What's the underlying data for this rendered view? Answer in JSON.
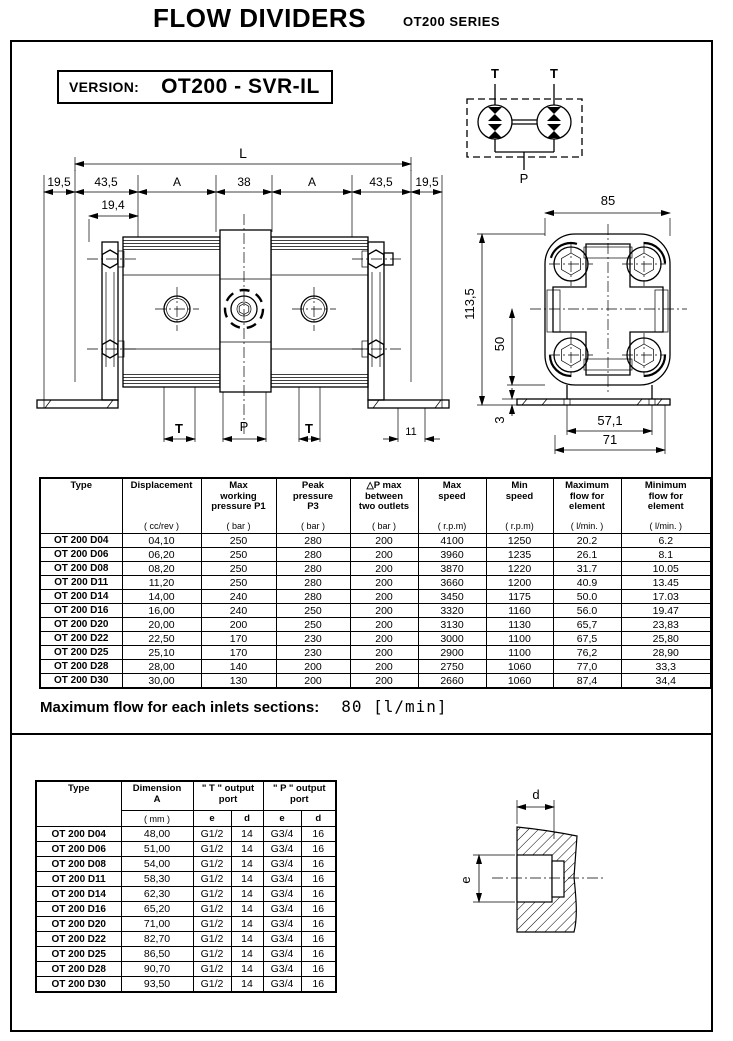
{
  "page": {
    "title": "FLOW DIVIDERS",
    "series": "OT200  SERIES",
    "version_label": "VERSION:",
    "version_value": "OT200 - SVR-IL"
  },
  "schematic": {
    "outlet_left": "T",
    "outlet_right": "T",
    "inlet": "P"
  },
  "front_view": {
    "dim_overall": "L",
    "dims_top": [
      "19,5",
      "43,5",
      "A",
      "38",
      "A",
      "43,5",
      "19,5"
    ],
    "dim_sub": "19,4",
    "port_left": "T",
    "port_center": "P",
    "port_right": "T",
    "dim_right": "11"
  },
  "end_view": {
    "dim_width": "85",
    "dim_height": "113,5",
    "dim_center": "50",
    "dim_base": "3",
    "dim_holes": "57,1",
    "dim_base_width": "71"
  },
  "spec_table": {
    "headers": [
      {
        "name": "Type",
        "unit": ""
      },
      {
        "name": "Displacement",
        "unit": "( cc/rev )"
      },
      {
        "name": "Max\nworking\npressure P1",
        "unit": "( bar )"
      },
      {
        "name": "Peak\npressure\nP3",
        "unit": "( bar )"
      },
      {
        "name": "△P  max\nbetween\ntwo outlets",
        "unit": "( bar )"
      },
      {
        "name": "Max\nspeed",
        "unit": "( r.p.m)"
      },
      {
        "name": "Min\nspeed",
        "unit": "( r.p.m)"
      },
      {
        "name": "Maximum\nflow for\nelement",
        "unit": "( l/min. )"
      },
      {
        "name": "Minimum\nflow for\nelement",
        "unit": "( l/min. )"
      }
    ],
    "rows": [
      [
        "OT 200 D04",
        "04,10",
        "250",
        "280",
        "200",
        "4100",
        "1250",
        "20.2",
        "6.2"
      ],
      [
        "OT 200 D06",
        "06,20",
        "250",
        "280",
        "200",
        "3960",
        "1235",
        "26.1",
        "8.1"
      ],
      [
        "OT 200 D08",
        "08,20",
        "250",
        "280",
        "200",
        "3870",
        "1220",
        "31.7",
        "10.05"
      ],
      [
        "OT 200 D11",
        "11,20",
        "250",
        "280",
        "200",
        "3660",
        "1200",
        "40.9",
        "13.45"
      ],
      [
        "OT 200 D14",
        "14,00",
        "240",
        "280",
        "200",
        "3450",
        "1175",
        "50.0",
        "17.03"
      ],
      [
        "OT 200 D16",
        "16,00",
        "240",
        "250",
        "200",
        "3320",
        "1160",
        "56.0",
        "19.47"
      ],
      [
        "OT 200 D20",
        "20,00",
        "200",
        "250",
        "200",
        "3130",
        "1130",
        "65,7",
        "23,83"
      ],
      [
        "OT 200 D22",
        "22,50",
        "170",
        "230",
        "200",
        "3000",
        "1100",
        "67,5",
        "25,80"
      ],
      [
        "OT 200 D25",
        "25,10",
        "170",
        "230",
        "200",
        "2900",
        "1100",
        "76,2",
        "28,90"
      ],
      [
        "OT 200 D28",
        "28,00",
        "140",
        "200",
        "200",
        "2750",
        "1060",
        "77,0",
        "33,3"
      ],
      [
        "OT 200 D30",
        "30,00",
        "130",
        "200",
        "200",
        "2660",
        "1060",
        "87,4",
        "34,4"
      ]
    ]
  },
  "max_flow_note": {
    "label": "Maximum flow for each inlets sections:",
    "value": "80  [l/min]"
  },
  "dim_table": {
    "col_type": "Type",
    "col_dim_name": "Dimension\nA",
    "col_dim_unit": "( mm )",
    "col_t_port": "\" T \" output\nport",
    "col_p_port": "\" P \" output\nport",
    "sub_e": "e",
    "sub_d": "d",
    "rows": [
      [
        "OT 200 D04",
        "48,00",
        "G1/2",
        "14",
        "G3/4",
        "16"
      ],
      [
        "OT 200 D06",
        "51,00",
        "G1/2",
        "14",
        "G3/4",
        "16"
      ],
      [
        "OT 200 D08",
        "54,00",
        "G1/2",
        "14",
        "G3/4",
        "16"
      ],
      [
        "OT 200 D11",
        "58,30",
        "G1/2",
        "14",
        "G3/4",
        "16"
      ],
      [
        "OT 200 D14",
        "62,30",
        "G1/2",
        "14",
        "G3/4",
        "16"
      ],
      [
        "OT 200 D16",
        "65,20",
        "G1/2",
        "14",
        "G3/4",
        "16"
      ],
      [
        "OT 200 D20",
        "71,00",
        "G1/2",
        "14",
        "G3/4",
        "16"
      ],
      [
        "OT 200 D22",
        "82,70",
        "G1/2",
        "14",
        "G3/4",
        "16"
      ],
      [
        "OT 200 D25",
        "86,50",
        "G1/2",
        "14",
        "G3/4",
        "16"
      ],
      [
        "OT 200 D28",
        "90,70",
        "G1/2",
        "14",
        "G3/4",
        "16"
      ],
      [
        "OT 200 D30",
        "93,50",
        "G1/2",
        "14",
        "G3/4",
        "16"
      ]
    ]
  },
  "port_section": {
    "dim_depth": "d",
    "dim_diameter": "e"
  }
}
